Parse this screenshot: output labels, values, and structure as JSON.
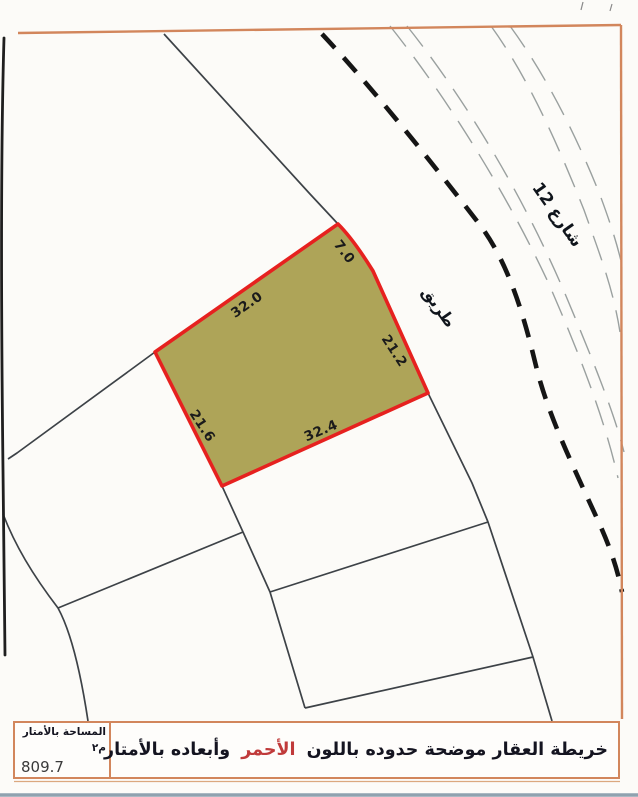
{
  "map": {
    "street_label": "شارع 12",
    "road_label": "طريق",
    "parcel": {
      "fill_color": "#aea458",
      "border_color": "#e6211f",
      "dimensions": {
        "north_west": "32.0",
        "north_east": "7.0",
        "east": "21.2",
        "south": "32.4",
        "west": "21.6"
      }
    }
  },
  "footer": {
    "area_label": "المساحة بالأمتار م٢",
    "area_value": "809.7",
    "note_prefix": "خريطة العقار موضحة حدوده باللون",
    "note_red_word": "الأحمر",
    "note_suffix": "وأبعاده بالأمتار",
    "accent_frame_color": "#d2865c",
    "red_word_color": "#c03a3a"
  }
}
